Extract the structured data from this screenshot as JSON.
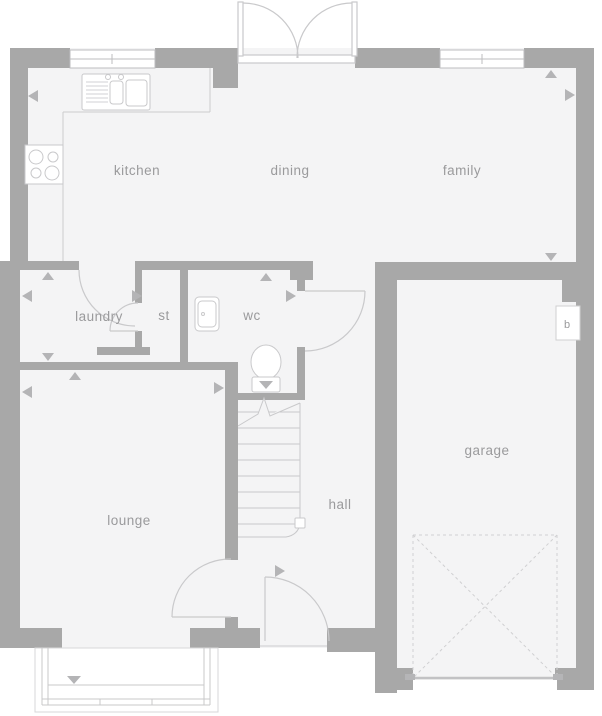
{
  "plan": {
    "type": "floor-plan",
    "rooms": {
      "kitchen": "kitchen",
      "dining": "dining",
      "family": "family",
      "laundry": "laundry",
      "store": "st",
      "wc": "wc",
      "lounge": "lounge",
      "hall": "hall",
      "garage": "garage",
      "boiler": "b"
    },
    "icons": [
      "sink-icon",
      "hob-icon",
      "basin-icon",
      "toilet-icon",
      "stairs-icon",
      "garage-door-icon",
      "bay-window-icon",
      "window-icon",
      "french-doors-icon",
      "door-swing-icon",
      "dimension-arrow-icon",
      "boiler-box-icon"
    ],
    "colors": {
      "wall": "#a8a8a8",
      "floor": "#f4f4f5",
      "background": "#ffffff",
      "fixture_line": "#c9c9cb",
      "window_line": "#bdbdbf",
      "label": "#9a9a9c",
      "marker": "#b4b4b6",
      "garage_door_dash": "#d0d0d2"
    }
  }
}
